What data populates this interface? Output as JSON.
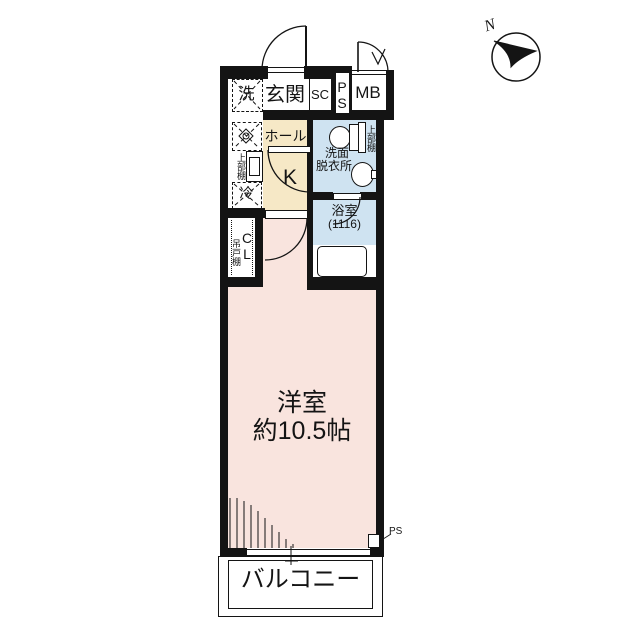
{
  "colors": {
    "wall": "#141414",
    "room_pink": "#f9e4de",
    "hall_tan": "#f6e8c6",
    "water_blue": "#cfe3f1"
  },
  "compass": {
    "north": "N"
  },
  "top_row": {
    "washer": "洗",
    "entrance": "玄関",
    "shoe_closet": "SC",
    "pipe_space": "PS",
    "meter_box": "MB"
  },
  "kitchen": {
    "hall": "ホール",
    "k": "K",
    "upper_shelf": "上部棚",
    "fridge": "冷"
  },
  "closet": {
    "name": "CL",
    "hanging_shelf": "吊戸棚"
  },
  "washroom": {
    "lines": [
      "洗面",
      "脱衣所"
    ],
    "upper_shelf": "上部棚"
  },
  "bathroom": {
    "name": "浴室",
    "size": "(1116)"
  },
  "western_room": {
    "name": "洋室",
    "size": "約10.5帖"
  },
  "balcony": {
    "name": "バルコニー"
  },
  "ps_bottom": {
    "label": "PS"
  }
}
